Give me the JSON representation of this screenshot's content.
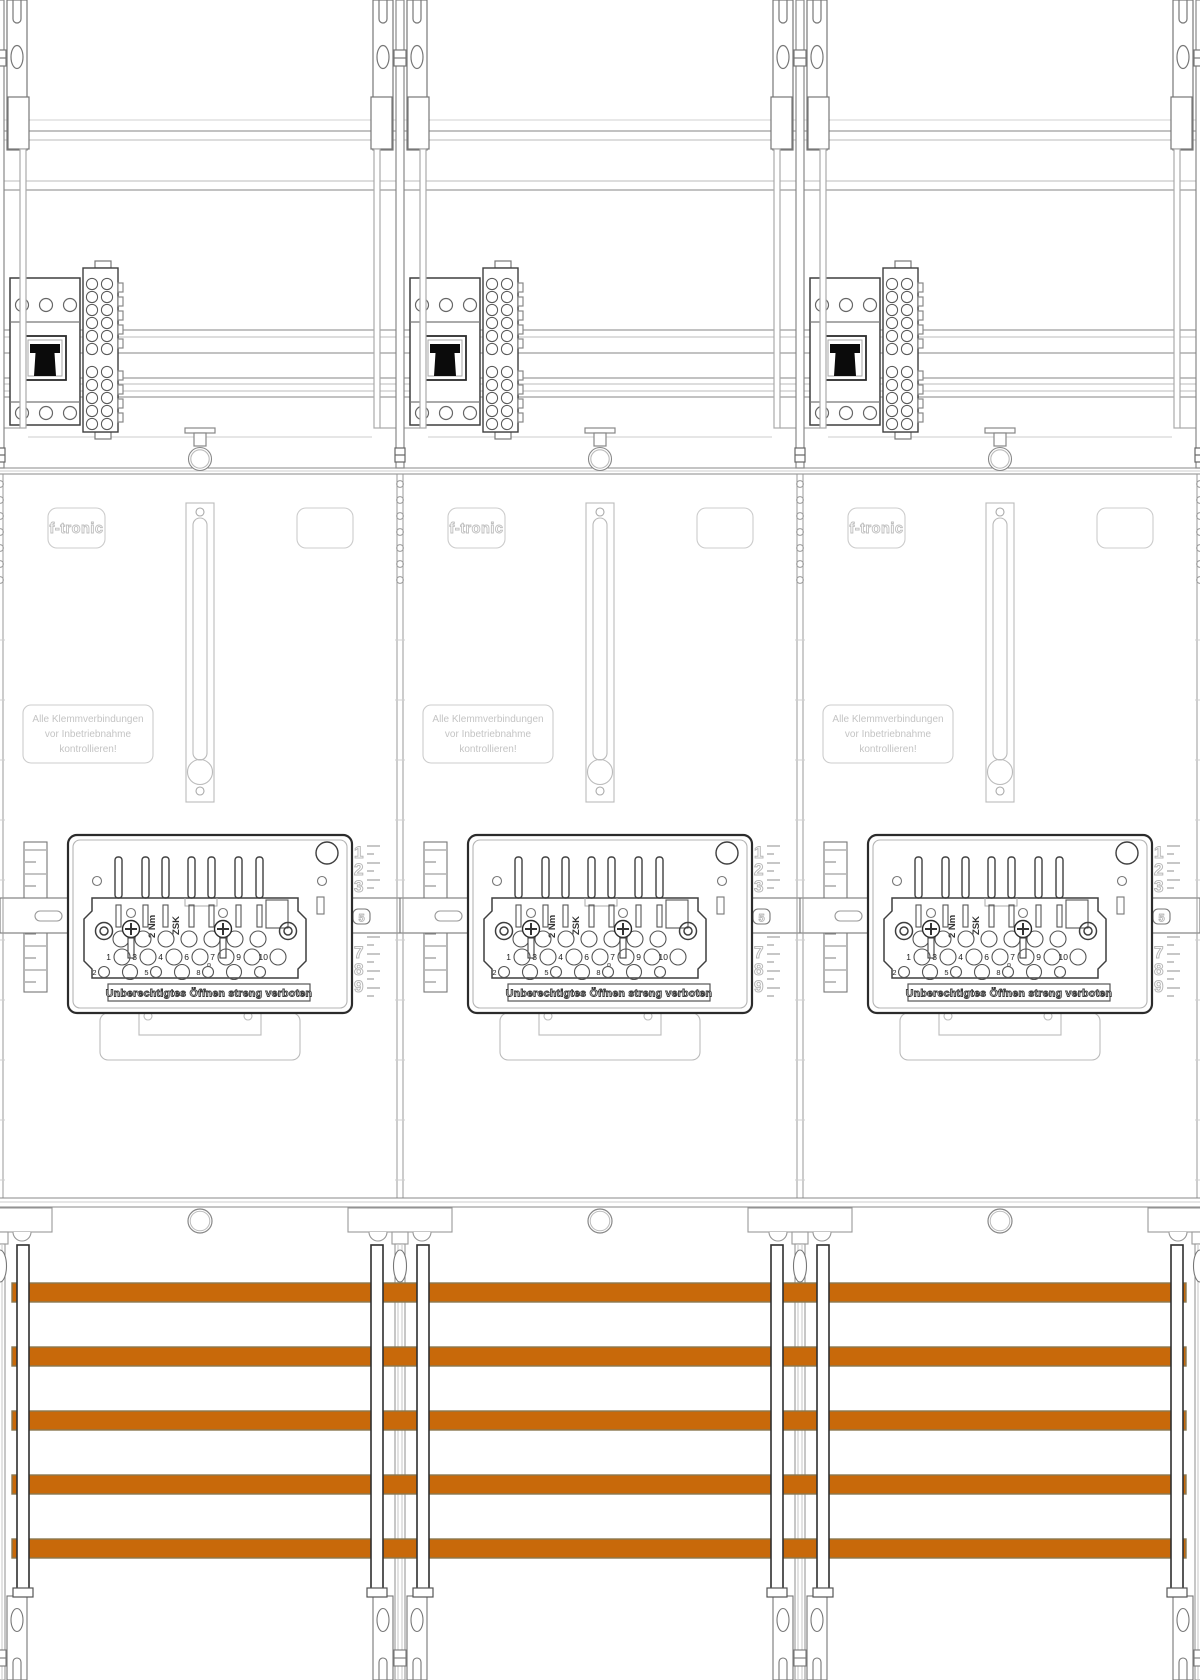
{
  "drawing": {
    "title": "meter-cabinet-line-drawing",
    "field_count": 3,
    "brand_label": "f-tronic",
    "warning_label": {
      "line1": "Alle Klemmverbindungen",
      "line2": "vor Inbetriebnahme",
      "line3": "kontrollieren!"
    },
    "cover": {
      "torque_label": "2 Nm",
      "model_label": "ZSK",
      "warning_strip": "Unberechtigtes Öffnen streng verboten",
      "terminal_row_upper": [
        "1",
        "3",
        "4",
        "6",
        "7",
        "9",
        "10"
      ],
      "terminal_row_lower": [
        "2",
        "5",
        "8"
      ],
      "rail_positions_upper": [
        "1",
        "2",
        "3"
      ],
      "rail_position_mid": "5",
      "rail_positions_lower": [
        "7",
        "8",
        "9"
      ]
    },
    "busbars": {
      "count": 5,
      "color": "#C8690A"
    },
    "colors": {
      "busbar_orange": "#C8690A",
      "faint_label_gray": "#C4C4C4",
      "line_dark": "#3F3F3F"
    }
  }
}
